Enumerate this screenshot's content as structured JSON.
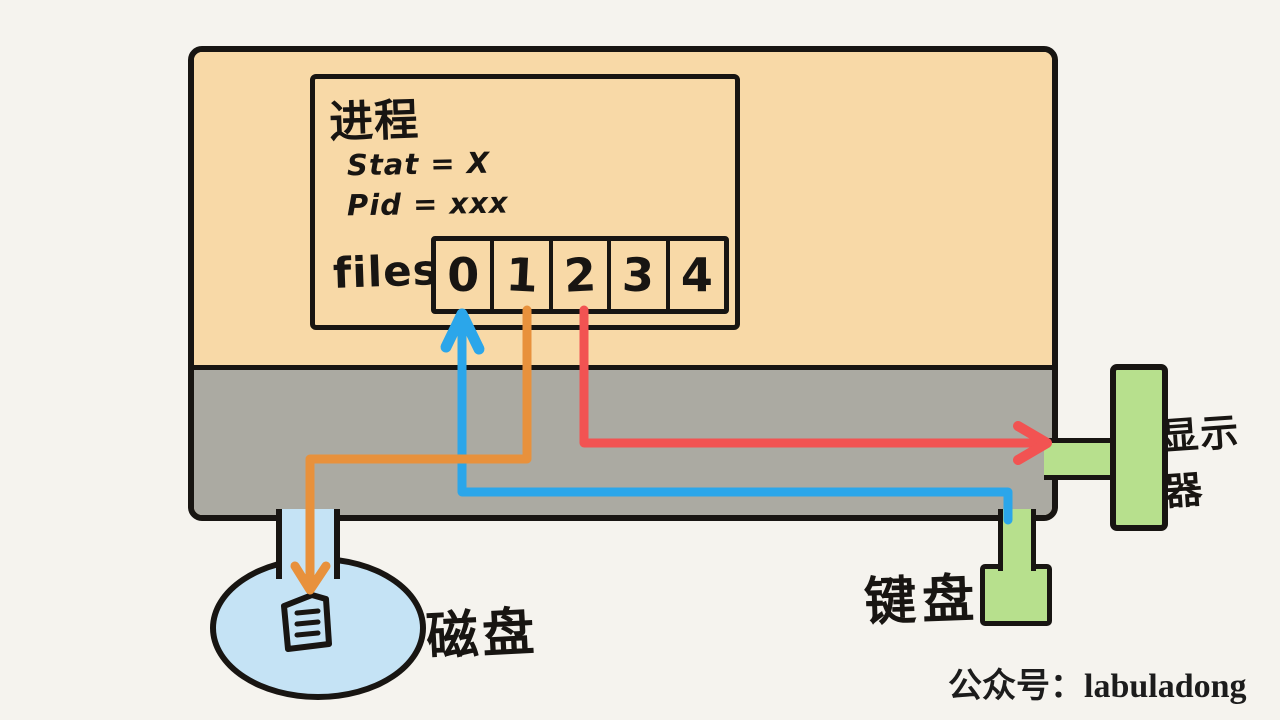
{
  "diagram_title": "process file descriptor table connected to I/O devices",
  "colors": {
    "background": "#f5f3ee",
    "user_space_fill": "#f8d9a7",
    "kernel_space_fill": "#abaaa2",
    "outline": "#181512",
    "arrow_blue": "#2ba6ea",
    "arrow_orange": "#e8913c",
    "arrow_red": "#f25352",
    "disk_fill": "#c5e3f5",
    "device_green": "#b7e08d"
  },
  "process_box": {
    "title": "进程",
    "stat_line": "Stat = X",
    "pid_line": "Pid = xxx",
    "files_label": "files",
    "fd_cells": [
      "0",
      "1",
      "2",
      "3",
      "4"
    ]
  },
  "devices": {
    "disk_label": "磁盘",
    "keyboard_label": "键盘",
    "display_label": "显示器"
  },
  "arrows": [
    {
      "color": "#2ba6ea",
      "fd": "0",
      "device": "键盘",
      "direction": "device-to-fd"
    },
    {
      "color": "#e8913c",
      "fd": "1",
      "device": "磁盘",
      "direction": "fd-to-device"
    },
    {
      "color": "#f25352",
      "fd": "2",
      "device": "显示器",
      "direction": "fd-to-device"
    }
  ],
  "watermark": "公众号：labuladong"
}
